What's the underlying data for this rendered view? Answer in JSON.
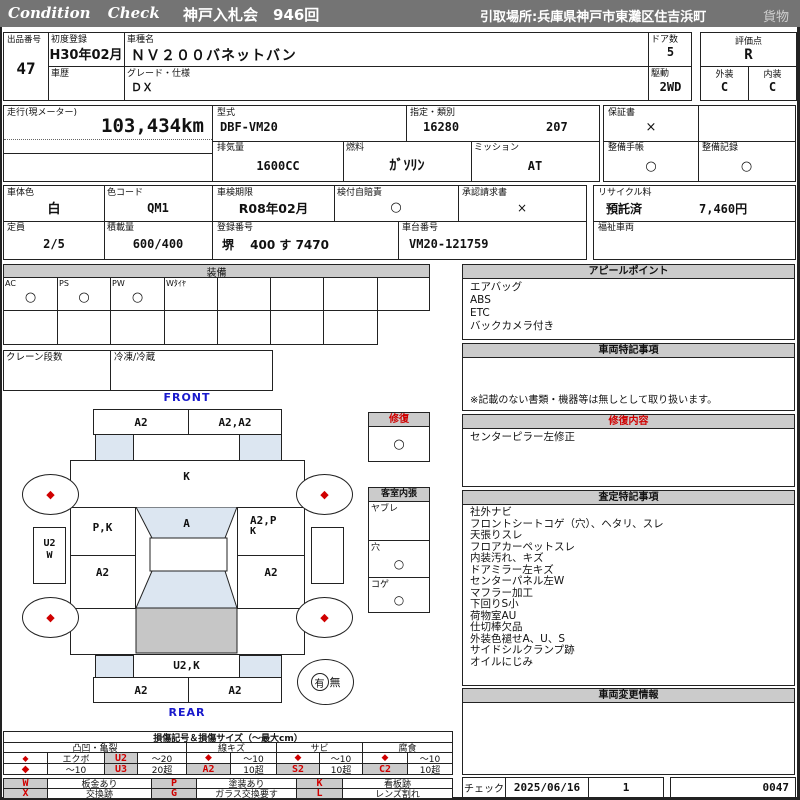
{
  "topbar": {
    "brand": "Condition Check",
    "auction": "神戸入札会　946回",
    "pickup": "引取場所:兵庫県神戸市東灘区住吉浜町",
    "cargo": "貨物"
  },
  "info": {
    "lot_label": "出品番号",
    "lot_no": "47",
    "first_reg_label": "初度登録",
    "first_reg": "H30年02月",
    "model_label": "車種名",
    "model": "ＮＶ２００バネットバン",
    "doors_label": "ドア数",
    "doors": "5",
    "score_label": "評価点",
    "score": "R",
    "history_label": "車歴",
    "grade_label": "グレード・仕様",
    "grade": "ＤＸ",
    "drive_label": "駆動",
    "drive": "2WD",
    "ext_label": "外装",
    "ext": "C",
    "int_label": "内装",
    "int": "C",
    "mileage_label": "走行(現メーター)",
    "mileage": "103,434km",
    "model_code_label": "型式",
    "model_code": "DBF-VM20",
    "class_label": "指定・類別",
    "class_no": "16280",
    "class_sub": "207",
    "warranty_label": "保証書",
    "warranty_mark": "×",
    "disp_label": "排気量",
    "disp": "1600CC",
    "fuel_label": "燃料",
    "fuel": "ｶﾞｿﾘﾝ",
    "mission_label": "ミッション",
    "mission": "AT",
    "book_label": "整備手帳",
    "book_mark": "○",
    "record_label": "整備記録",
    "record_mark": "○",
    "body_color_label": "車体色",
    "body_color": "白",
    "color_code_label": "色コード",
    "color_code": "QM1",
    "inspection_label": "車検期限",
    "inspection": "R08年02月",
    "jibaiseki_label": "検付自賠責",
    "jibaiseki_mark": "○",
    "approval_label": "承認請求書",
    "approval_mark": "×",
    "recycle_label": "リサイクル料",
    "recycle_status": "預託済",
    "recycle_fee": "7,460円",
    "capacity_label": "定員",
    "capacity": "2/5",
    "load_label": "積載量",
    "load": "600/400",
    "reg_label": "登録番号",
    "reg_no": "堺　 400 す 7470",
    "chassis_label": "車台番号",
    "chassis_no": "VM20-121759",
    "welfare_label": "福祉車両"
  },
  "equipment": {
    "title": "装備",
    "i0": "AC",
    "m0": "○",
    "i1": "PS",
    "m1": "○",
    "i2": "PW",
    "m2": "○",
    "i3": "Wﾀｲﾔ",
    "crane_label": "クレーン段数",
    "reefer_label": "冷凍/冷蔵"
  },
  "diagram": {
    "front": "FRONT",
    "rear": "REAR",
    "fb_l": "A2",
    "fb_r": "A2,A2",
    "hood": "K",
    "lf": "P,K",
    "ws": "A",
    "rf1": "A2,P",
    "rf2": "K",
    "lm": "A2",
    "rm": "A2",
    "step1": "U2",
    "step2": "W",
    "rp": "U2,K",
    "rb_l": "A2",
    "rb_r": "A2",
    "wheel_mark": "◆",
    "spare_yes": "有",
    "spare_no": "無"
  },
  "repair": {
    "title": "修復",
    "mark": "○"
  },
  "trim": {
    "title": "客室内張",
    "r0": "ヤブレ",
    "m0": "",
    "r1": "穴",
    "m1": "○",
    "r2": "コゲ",
    "m2": "○"
  },
  "appeal": {
    "title": "アピールポイント",
    "l0": "エアバッグ",
    "l1": "ABS",
    "l2": "ETC",
    "l3": "バックカメラ付き"
  },
  "notes": {
    "title": "車両特記事項",
    "disclaimer": "※記載のない書類・機器等は無しとして取り扱います。"
  },
  "repair_detail": {
    "title": "修復内容",
    "l0": "センターピラー左修正"
  },
  "assessment": {
    "title": "査定特記事項",
    "l0": "社外ナビ",
    "l1": "フロントシートコゲ（穴）、ヘタリ、スレ",
    "l2": "天張りスレ",
    "l3": "フロアカーペットスレ",
    "l4": "内装汚れ、キズ",
    "l5": "ドアミラー左キズ",
    "l6": "センターパネル左W",
    "l7": "マフラー加工",
    "l8": "下回りS小",
    "l9": "荷物室AU",
    "l10": "仕切棒欠品",
    "l11": "外装色褪せA、U、S",
    "l12": "サイドシルクランプ跡",
    "l13": "オイルにじみ"
  },
  "change_info": {
    "title": "車両変更情報"
  },
  "footer": {
    "check_label": "チェック",
    "date": "2025/06/16",
    "count": "1",
    "serial": "0047"
  },
  "legend": {
    "title": "損傷記号＆損傷サイズ（～最大cm）",
    "g0": "凸凹・亀裂",
    "g1": "線キズ",
    "g2": "サビ",
    "g3": "腐食",
    "dia": "◆",
    "dent_r1_label": "エクボ",
    "dent_r1_code": "U2",
    "dent_r1_size": "～20",
    "dent_r2_label": "～10",
    "dent_r2_code": "U3",
    "dent_r2_size": "20超",
    "line_r1_size": "～10",
    "line_r2_code": "A2",
    "line_r2_size": "10超",
    "rust_r1_size": "～10",
    "rust_r2_code": "S2",
    "rust_r2_size": "10超",
    "cor_r1_size": "～10",
    "cor_r2_code": "C2",
    "cor_r2_size": "10超",
    "c0": "W",
    "c0l": "板金あり",
    "c1": "P",
    "c1l": "塗装あり",
    "c2": "K",
    "c2l": "看板跡",
    "c3": "X",
    "c3l": "交換跡",
    "c4": "G",
    "c4l": "ガラス交換要す",
    "c5": "L",
    "c5l": "レンズ割れ"
  },
  "colors": {
    "accent_red": "#d00000",
    "topbar_gray": "#747474",
    "header_gray": "#cbcbcb",
    "panel_blue": "#dce6f1",
    "cargo_gray": "#c6c6c6",
    "label_blue": "#1a1acc"
  }
}
